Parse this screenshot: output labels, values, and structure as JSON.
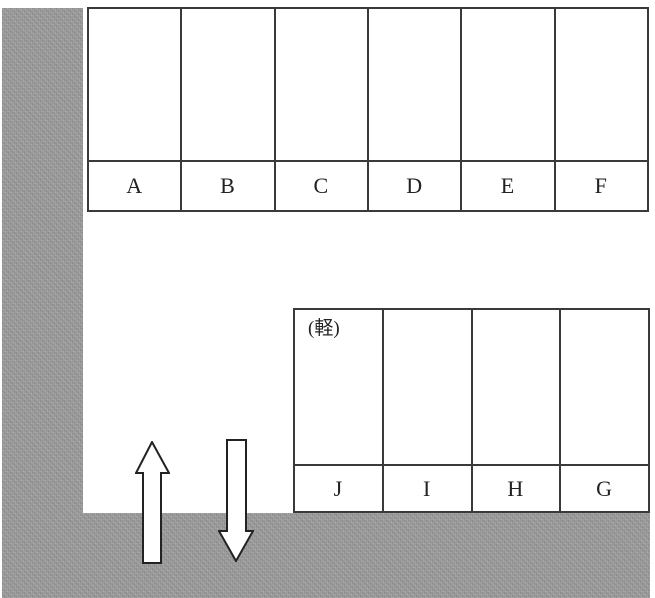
{
  "page": {
    "background_color": "#ffffff",
    "road_color": "#9c9c9c",
    "line_color": "#3a3a3a"
  },
  "parking": {
    "top_row": {
      "spaces": [
        {
          "label": "A"
        },
        {
          "label": "B"
        },
        {
          "label": "C"
        },
        {
          "label": "D"
        },
        {
          "label": "E"
        },
        {
          "label": "F"
        }
      ]
    },
    "bottom_row": {
      "spaces": [
        {
          "label": "J",
          "note": "(軽)"
        },
        {
          "label": "I"
        },
        {
          "label": "H"
        },
        {
          "label": "G"
        }
      ]
    },
    "arrows": [
      {
        "icon": "up-arrow-icon"
      },
      {
        "icon": "down-arrow-icon"
      }
    ]
  }
}
